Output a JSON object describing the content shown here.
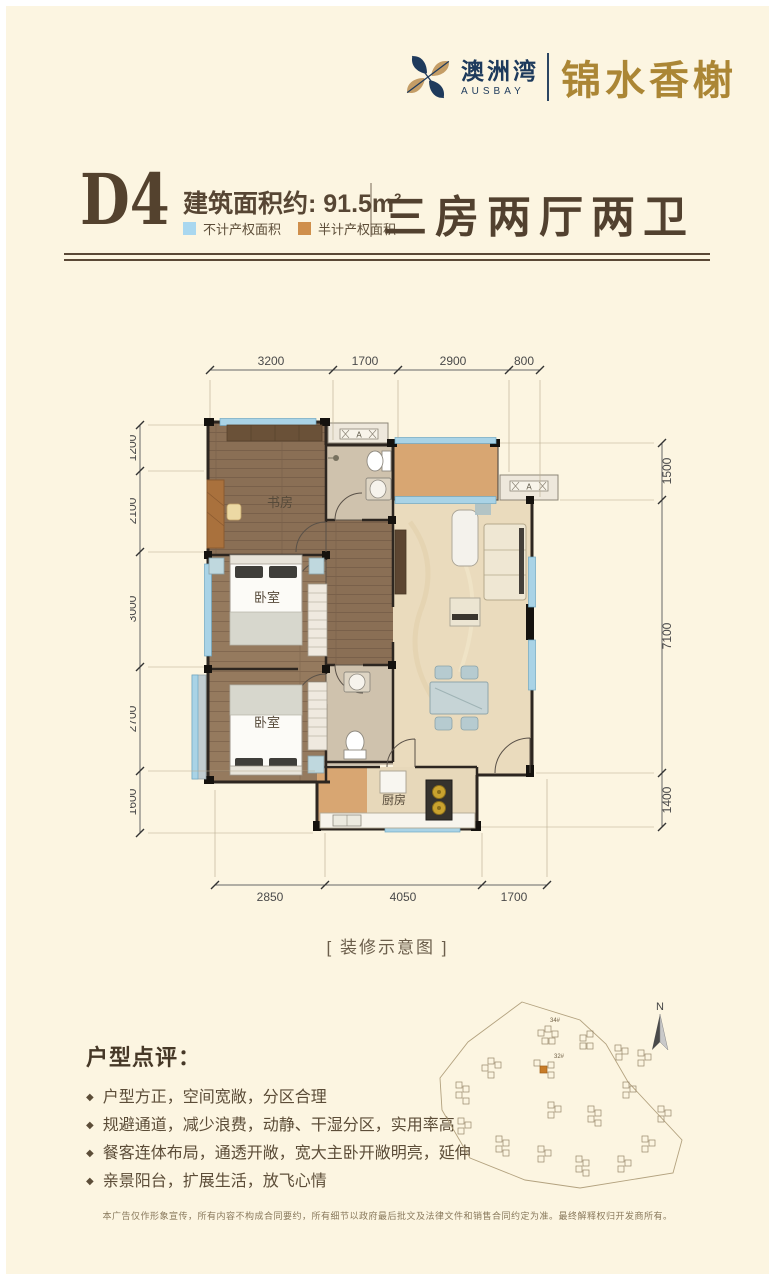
{
  "header": {
    "brand_cn": "澳洲湾",
    "brand_en": "AUSBAY",
    "project_name": "锦水香榭"
  },
  "title": {
    "unit": "D4",
    "area_label": "建筑面积约:",
    "area_value": " 91.5m",
    "area_sup": "2",
    "legend": [
      {
        "label": "不计产权面积",
        "color": "#a9d7ef"
      },
      {
        "label": "半计产权面积",
        "color": "#cf8f4c"
      }
    ],
    "layout_desc": "三房两厅两卫"
  },
  "floorplan": {
    "rooms": {
      "study": "书房",
      "bedroom": "卧室",
      "kitchen": "厨房"
    },
    "ac_label": "A",
    "dims_top": [
      "3200",
      "1700",
      "2900",
      "800"
    ],
    "dims_left": [
      "1200",
      "2100",
      "3000",
      "2700",
      "1600"
    ],
    "dims_right": [
      "1500",
      "7100",
      "1400"
    ],
    "dims_bottom": [
      "2850",
      "4050",
      "1700"
    ],
    "caption": "[ 装修示意图 ]"
  },
  "review": {
    "title": "户型点评：",
    "bullet": "◆",
    "points": [
      "户型方正，空间宽敞，分区合理",
      "规避通道，减少浪费，动静、干湿分区，实用率高",
      "餐客连体布局，通透开敞，宽大主卧开敞明亮，延伸",
      "亲景阳台，扩展生活，放飞心情"
    ]
  },
  "sitemap": {
    "compass_label": "N",
    "building_labels": [
      "34#",
      "32#"
    ]
  },
  "disclaimer": "本广告仅作形象宣传，所有内容不构成合同要约，所有细节以政府最后批文及法律文件和销售合同约定为准。最终解释权归开发商所有。",
  "colors": {
    "background": "#fcf5e1",
    "brand_navy": "#1d3a5c",
    "brand_gold": "#ab8635",
    "title_brown": "#54422e",
    "legend_blue": "#a9d7ef",
    "legend_orange": "#cf8f4c",
    "wall": "#2d2620",
    "wood_floor": "#8a6f55",
    "marble_floor": "#eadbbd",
    "balcony_orange": "#d8a672",
    "window_blue": "#a9d3e6"
  }
}
